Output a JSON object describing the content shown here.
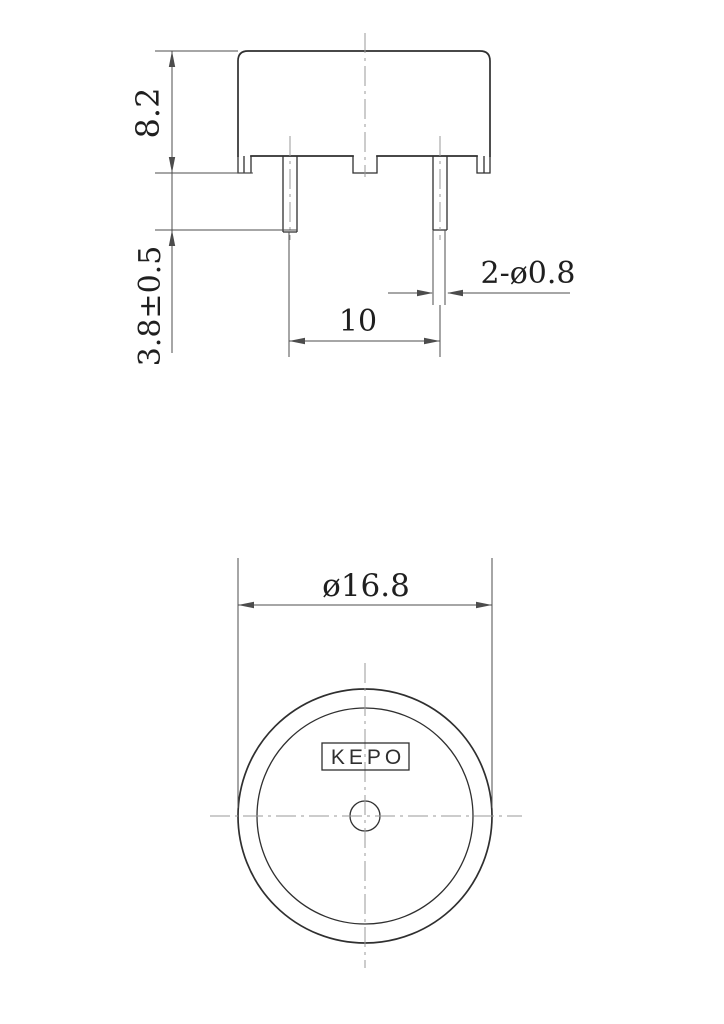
{
  "drawing_type": "technical-drawing",
  "side_view": {
    "height_dim": "8.2",
    "lead_length_dim": "3.8±0.5",
    "pin_spacing_dim": "10",
    "pin_diameter_dim": "2-ø0.8"
  },
  "bottom_view": {
    "diameter_dim": "ø16.8",
    "brand": "KEPO"
  },
  "colors": {
    "background": "#ffffff",
    "line": "#2f2f2f",
    "dim_line": "#4c4c4c",
    "centerline": "#9a9a9a",
    "text": "#1f1f1f"
  }
}
